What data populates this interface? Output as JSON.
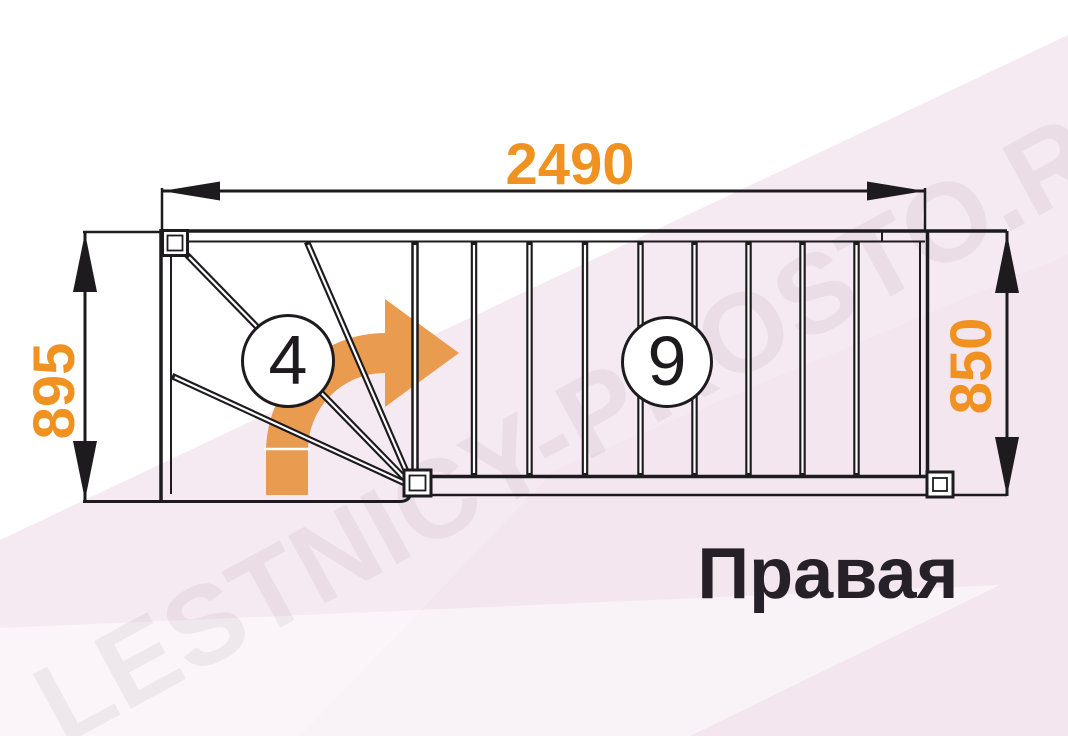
{
  "diagram": {
    "title": "staircase-floor-plan",
    "orientation_label": "Правая",
    "dimensions": {
      "top_width": "2490",
      "left_depth": "895",
      "right_height": "850"
    },
    "winder_steps_count": "4",
    "straight_steps_count": "9",
    "watermark": "LESTNICY-PROSTO.RU",
    "colors": {
      "dimension_orange": "#EF9221",
      "arrow_orange": "#E99C4F",
      "line_black": "#1D1B1E",
      "background_pink": "#F6EAF2",
      "background_pink_deep": "#F1E1EB",
      "orientation_text": "#262028"
    }
  }
}
